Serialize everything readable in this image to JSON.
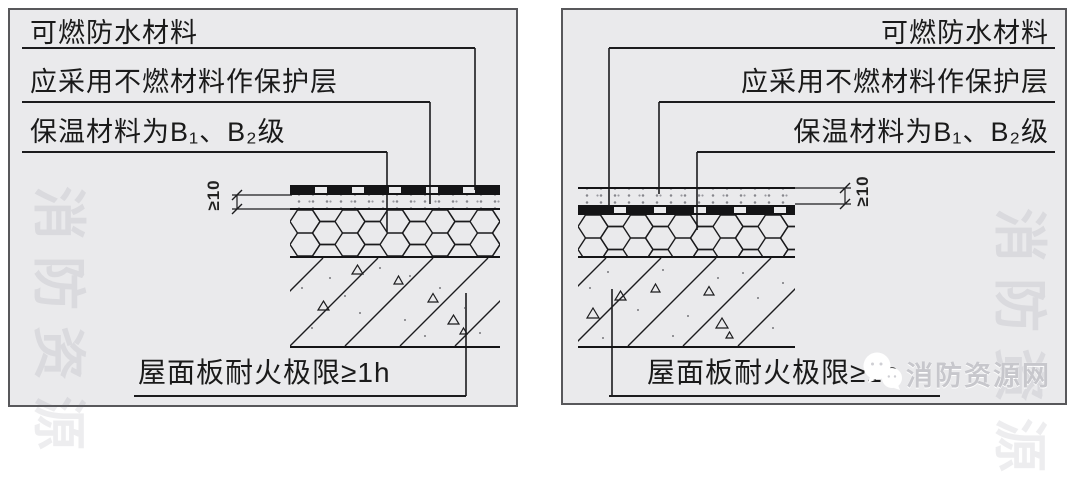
{
  "figure": {
    "panels": [
      {
        "id": "left",
        "labels": {
          "waterproof": "可燃防水材料",
          "protective": "应采用不燃材料作保护层",
          "insulation": "保温材料为B₁、B₂级",
          "roof_slab": "屋面板耐火极限≥1h",
          "thickness": "≥10"
        }
      },
      {
        "id": "right",
        "labels": {
          "waterproof": "可燃防水材料",
          "protective": "应采用不燃材料作保护层",
          "insulation": "保温材料为B₁、B₂级",
          "roof_slab": "屋面板耐火极限≥1h",
          "thickness": "≥10"
        }
      }
    ]
  },
  "watermark": {
    "site_name": "消防资源网",
    "logo_icon": "wechat-icon",
    "glyph_text": "消防资源"
  },
  "colors": {
    "panel_background": "#eaeaec",
    "line": "#1c1c1e",
    "text": "#1a1a1a",
    "watermark_text": "#c7c7cc"
  }
}
